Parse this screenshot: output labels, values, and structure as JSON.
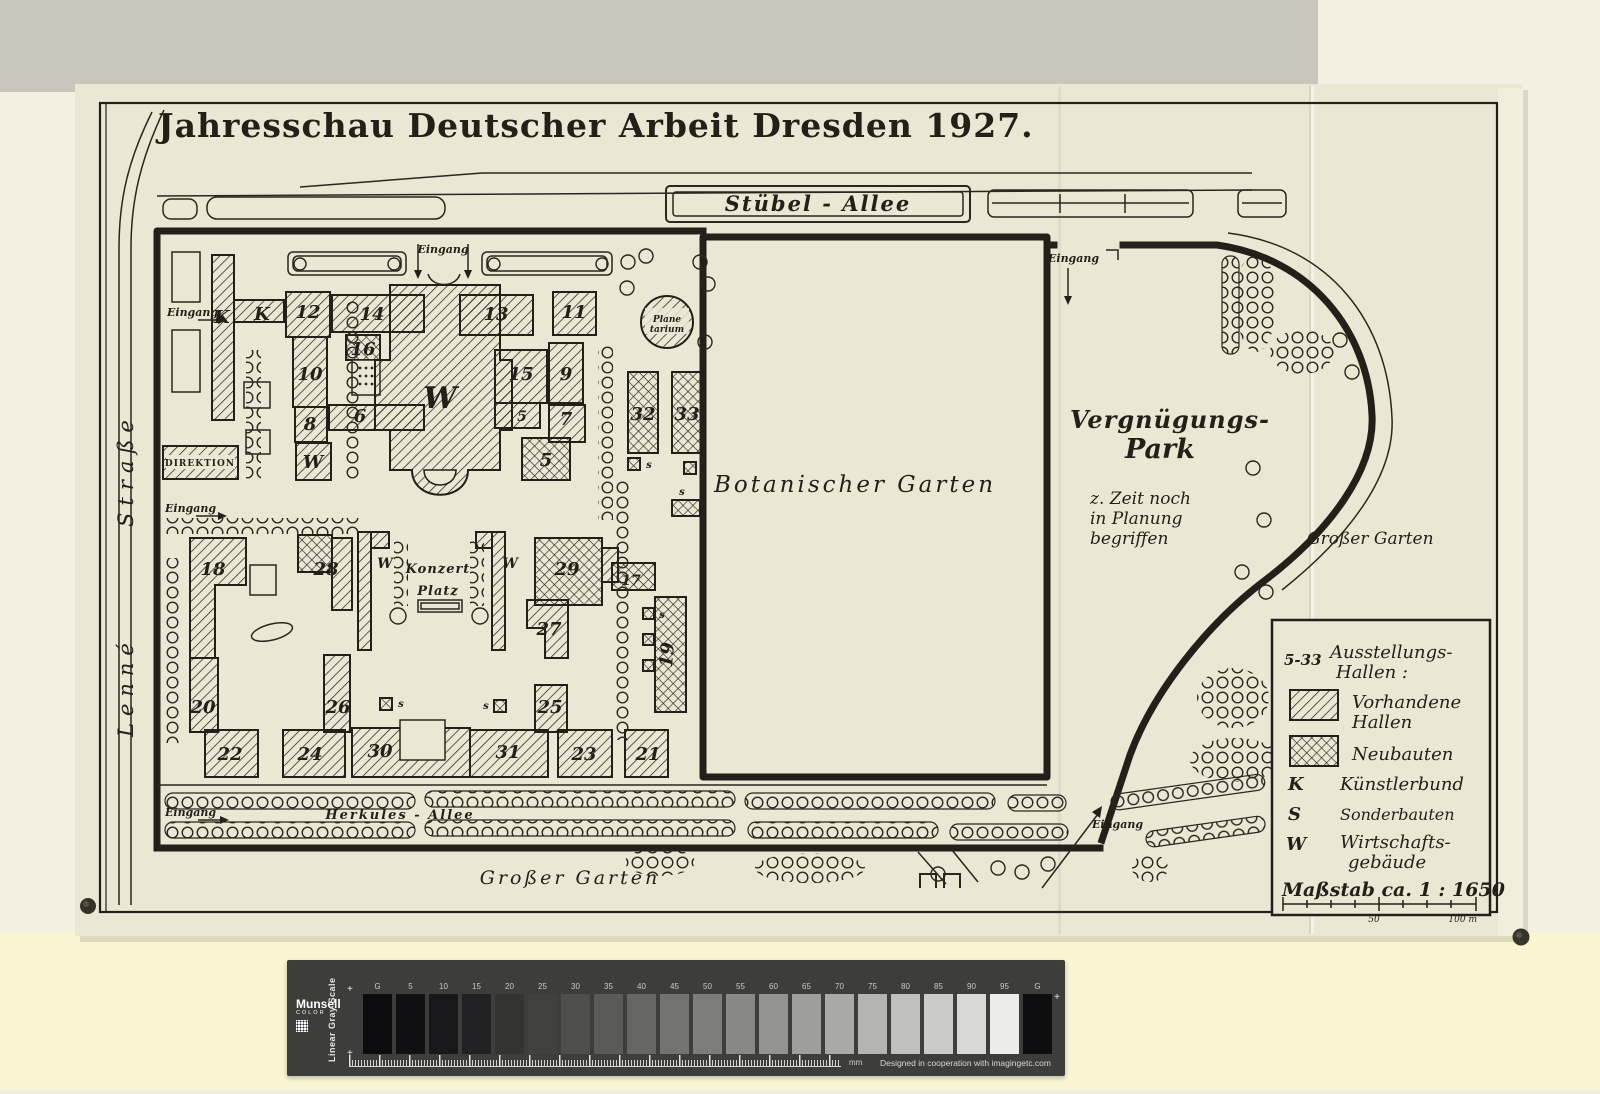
{
  "title": "Jahresschau Deutscher Arbeit Dresden 1927.",
  "streets": {
    "stuebel": "Stübel - Allee",
    "lenne_name": "Lenné",
    "lenne_type": "Straße",
    "herkules": "Herkules - Allee"
  },
  "areas": {
    "botanischer": "Botanischer Garten",
    "verg1": "Vergnügungs-",
    "verg2": "Park",
    "note1": "z. Zeit noch",
    "note2": "in Planung",
    "note3": "begriffen",
    "grosser": "Großer Garten",
    "konzert1": "Konzert",
    "konzert2": "Platz",
    "plan1": "Plane",
    "plan2": "tarium",
    "direktion": "DIREKTION"
  },
  "eingang": "Eingang",
  "keys": {
    "k": "K",
    "s": "s",
    "w": "W"
  },
  "buildings": {
    "b5": "5",
    "b6": "6",
    "b7": "7",
    "b8": "8",
    "b9": "9",
    "b10": "10",
    "b11": "11",
    "b12": "12",
    "b13": "13",
    "b14": "14",
    "b15": "15",
    "b16": "16",
    "b17": "17",
    "b18": "18",
    "b19": "19",
    "b20": "20",
    "b21": "21",
    "b22": "22",
    "b23": "23",
    "b24": "24",
    "b25": "25",
    "b26": "26",
    "b27": "27",
    "b28": "28",
    "b29": "29",
    "b30": "30",
    "b31": "31",
    "b32": "32",
    "b33": "33"
  },
  "legend": {
    "range": "5-33",
    "head1": "Ausstellungs-",
    "head2": "Hallen :",
    "ex1": "Vorhandene",
    "ex2": "Hallen",
    "neu": "Neubauten",
    "k_key": "K",
    "k_label": "Künstlerbund",
    "s_key": "S",
    "s_label": "Sonderbauten",
    "w_key": "W",
    "w_label1": "Wirtschafts-",
    "w_label2": "gebäude",
    "scale_text": "Maßstab ca. 1 : 1650",
    "scale_mid": "50",
    "scale_end": "100 m"
  },
  "grayscale": {
    "brand": "Munsell",
    "brand_sub": "COLOR",
    "scale_name": "Linear Gray Scale",
    "plus": "+",
    "unit": "mm",
    "credit": "Designed in cooperation with imagingetc.com",
    "patches": [
      {
        "label": "G",
        "color": "#0c0c0e"
      },
      {
        "label": "5",
        "color": "#101012"
      },
      {
        "label": "10",
        "color": "#18181a"
      },
      {
        "label": "15",
        "color": "#222224"
      },
      {
        "label": "20",
        "color": "#333331"
      },
      {
        "label": "25",
        "color": "#414140"
      },
      {
        "label": "30",
        "color": "#4e4e4c"
      },
      {
        "label": "35",
        "color": "#5a5a58"
      },
      {
        "label": "40",
        "color": "#666664"
      },
      {
        "label": "45",
        "color": "#727270"
      },
      {
        "label": "50",
        "color": "#7d7d7b"
      },
      {
        "label": "55",
        "color": "#888886"
      },
      {
        "label": "60",
        "color": "#939391"
      },
      {
        "label": "65",
        "color": "#9e9e9c"
      },
      {
        "label": "70",
        "color": "#a9a9a7"
      },
      {
        "label": "75",
        "color": "#b4b4b2"
      },
      {
        "label": "80",
        "color": "#c0c0be"
      },
      {
        "label": "85",
        "color": "#cbcbc9"
      },
      {
        "label": "90",
        "color": "#d8d8d6"
      },
      {
        "label": "95",
        "color": "#ececea"
      },
      {
        "label": "G",
        "color": "#0e0e10"
      }
    ]
  }
}
